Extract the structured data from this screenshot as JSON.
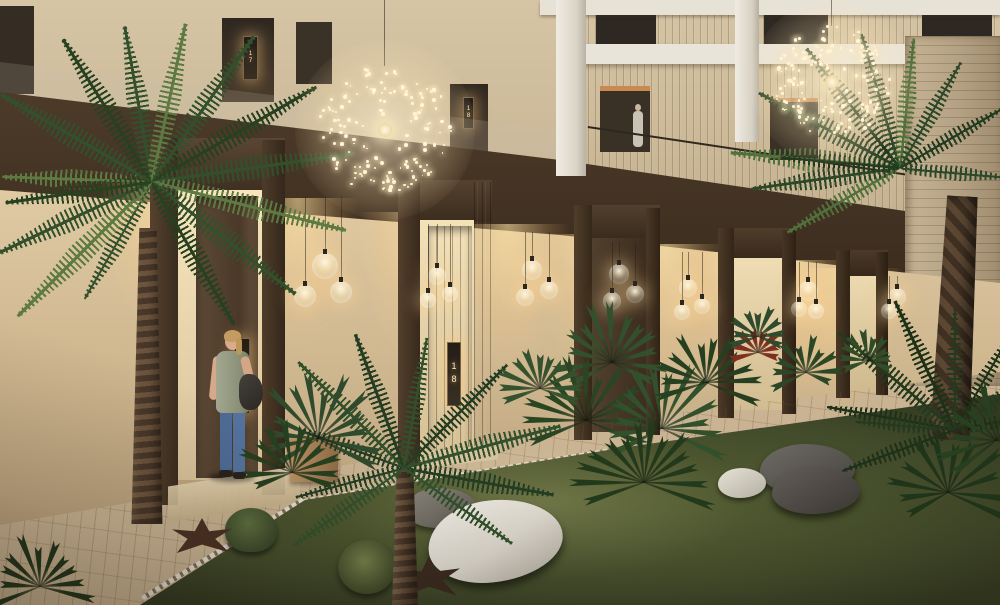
{
  "scene": {
    "doors": {
      "ground": [
        "17",
        "18"
      ],
      "upper": [
        "17",
        "18"
      ]
    },
    "objects": {
      "chandelier": "dandelion-sphere-chandelier",
      "pendant": "glass-globe-pendant-light",
      "person_ground": "woman-standing-at-door-17",
      "person_upper": "person-on-upper-walkway",
      "vegetation": [
        "date-palm",
        "fan-palm",
        "cactus",
        "agave"
      ],
      "ground_cover": [
        "grass-lawn",
        "stone-path",
        "marble-boulder",
        "grey-boulders"
      ]
    },
    "palette": {
      "wall_beige": "#dcc9a6",
      "wall_lit": "#f4e4c0",
      "wood_dark": "#4a3828",
      "door_wood": "#4c3a2b",
      "white_frame": "#e9e4d9",
      "light_glow": "#ffdf9e",
      "grass": "#3f4628",
      "path_stone": "#c3a987",
      "leaf_dark": "#2f4a2c",
      "leaf_light": "#5d7a42",
      "stone_white": "#ddd8cd",
      "stone_grey": "#504b46",
      "jeans_blue": "#4e6c97",
      "skin": "#d7a98a",
      "hair_blonde": "#c49c62"
    }
  }
}
